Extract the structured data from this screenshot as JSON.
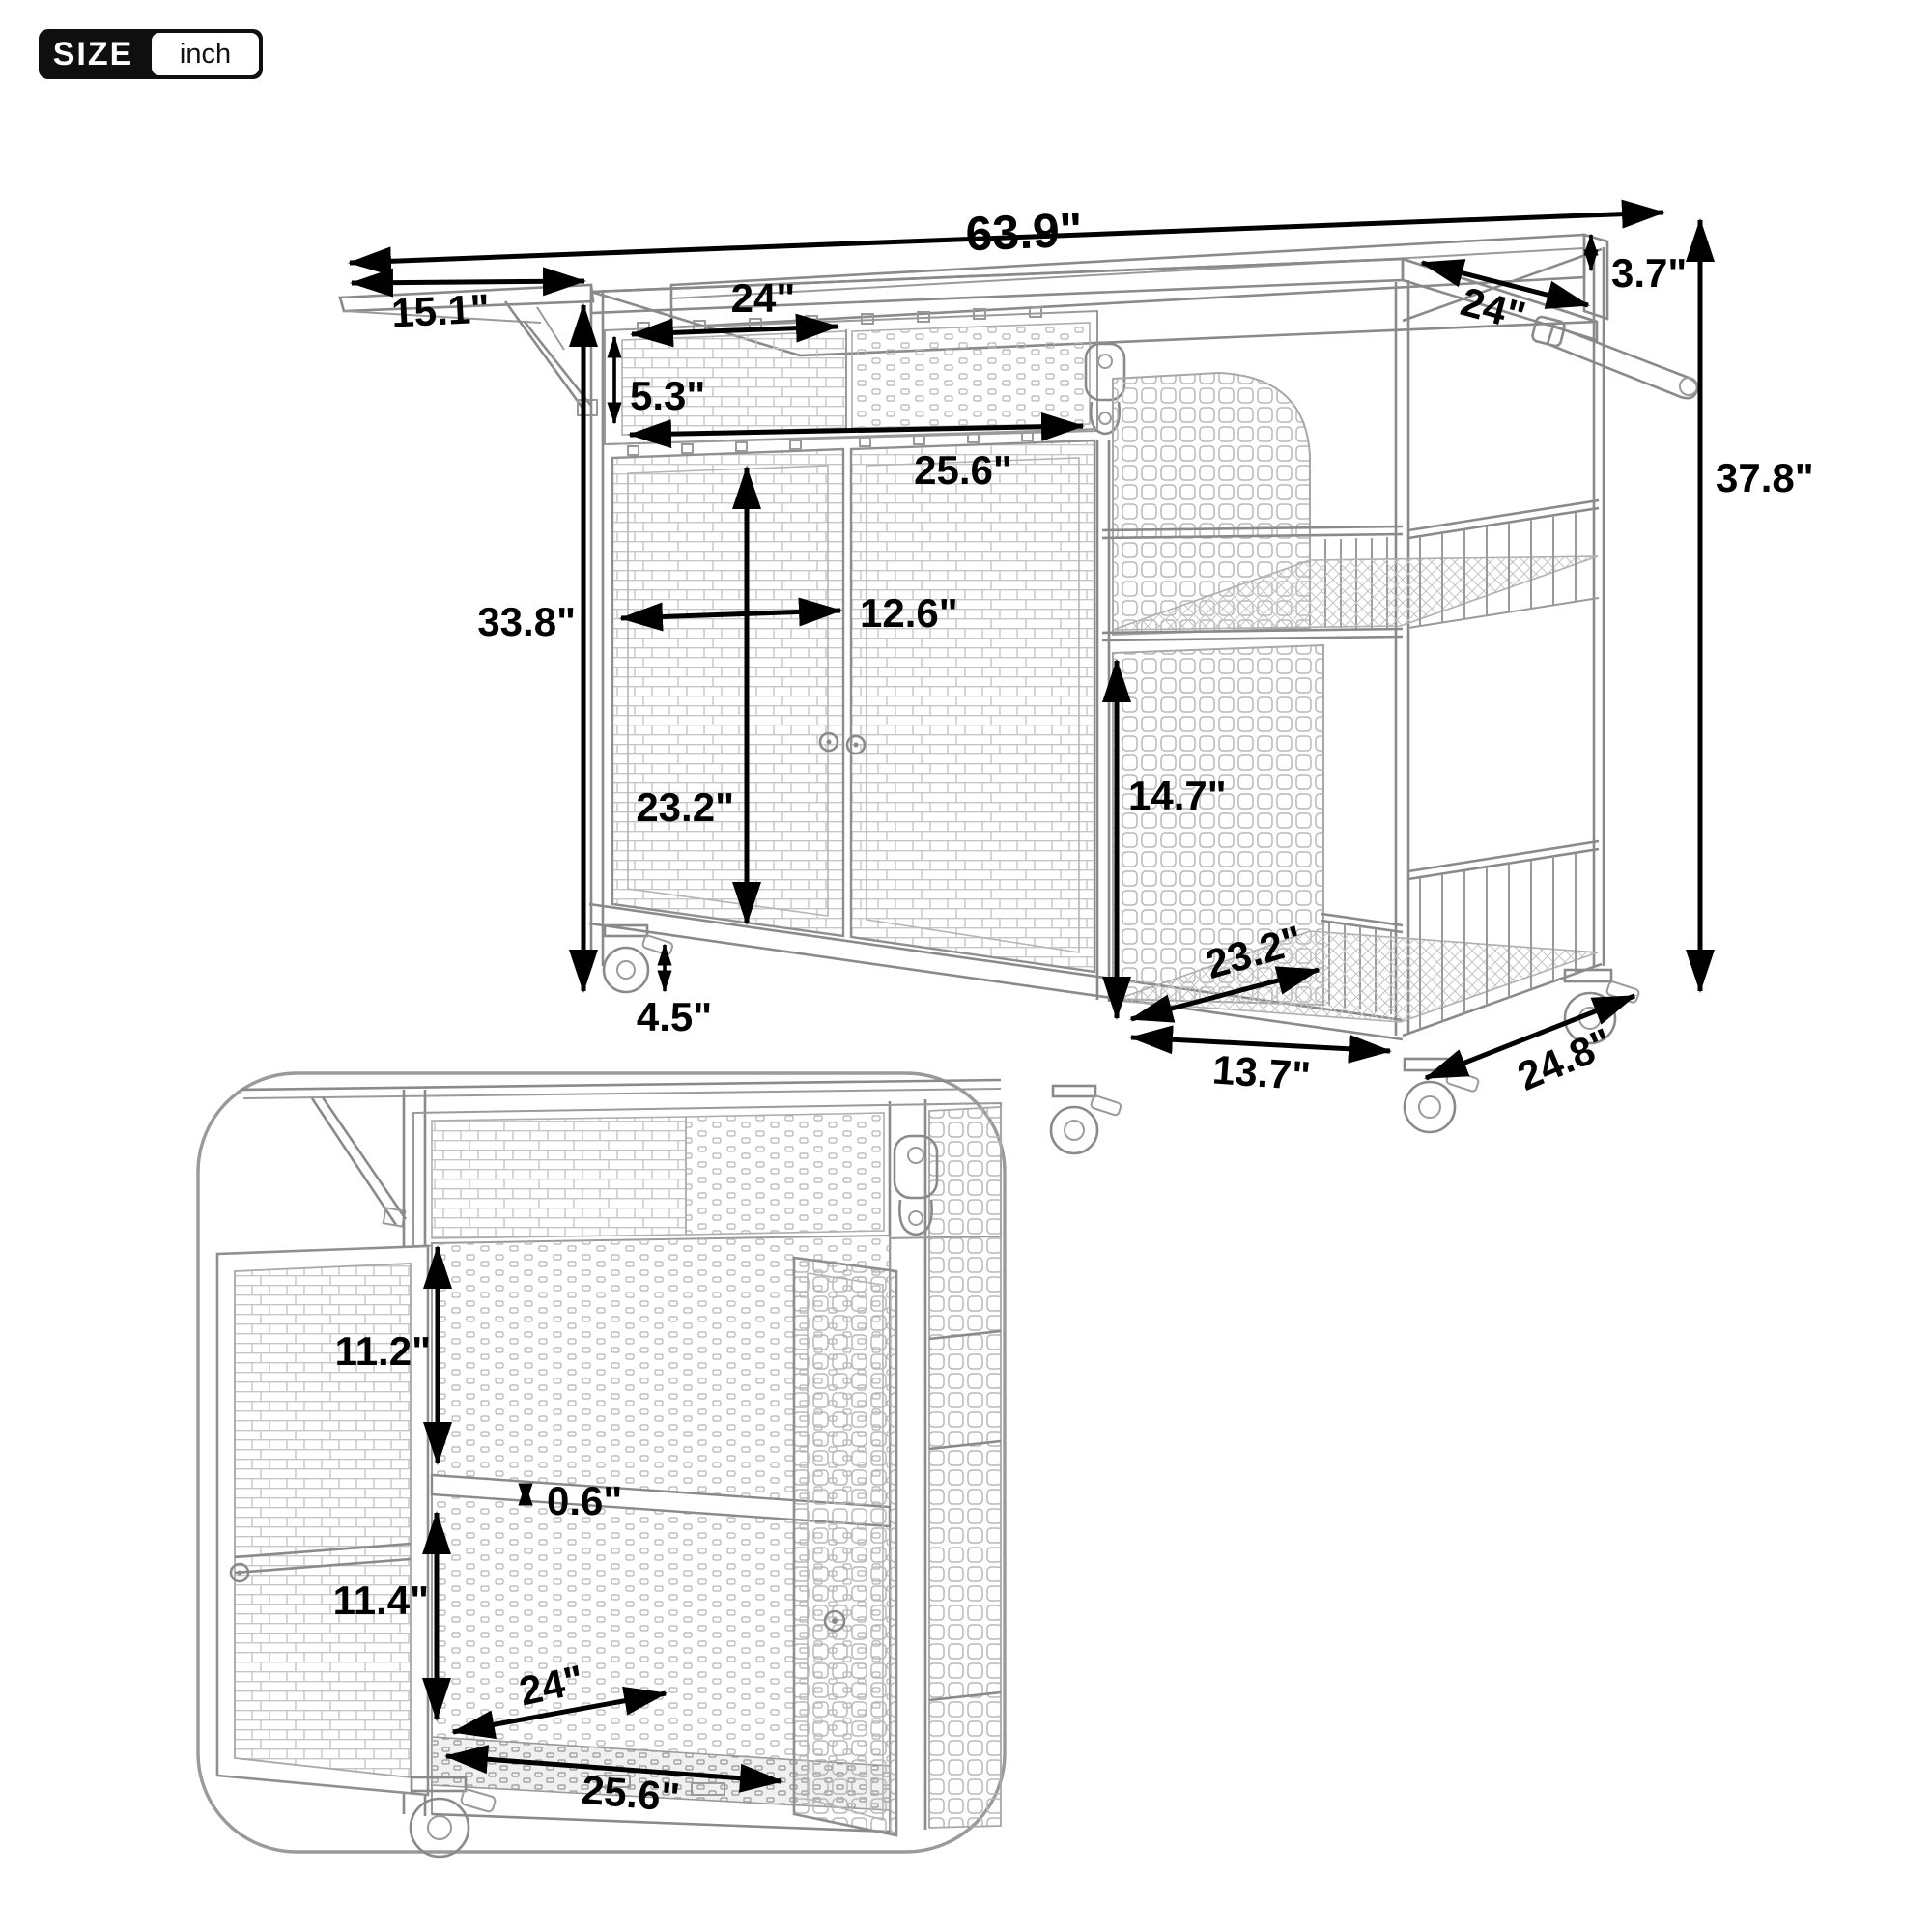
{
  "badge": {
    "label": "SIZE",
    "unit": "inch"
  },
  "palette": {
    "dim_color": "#000000",
    "line_color": "#8a8a8a",
    "badge_bg": "#0f0f0f",
    "badge_text": "#ffffff",
    "background": "#ffffff"
  },
  "main_view": {
    "dims": {
      "total_width": "63.9\"",
      "leaf_depth": "15.1\"",
      "top_opening_width": "24\"",
      "top_opening_height": "5.3\"",
      "cabinet_width": "25.6\"",
      "door_width": "12.6\"",
      "body_height": "33.8\"",
      "door_height": "23.2\"",
      "ground_clearance": "4.5\"",
      "side_shelf_height": "14.7\"",
      "side_shelf_depth": "23.2\"",
      "side_shelf_width": "13.7\"",
      "base_depth": "24.8\"",
      "total_height": "37.8\"",
      "back_rail_height": "3.7\"",
      "top_depth": "24\""
    }
  },
  "inset_view": {
    "dims": {
      "upper_compartment_height": "11.2\"",
      "shelf_thickness": "0.6\"",
      "lower_compartment_height": "11.4\"",
      "interior_depth": "24\"",
      "interior_width": "25.6\""
    }
  }
}
